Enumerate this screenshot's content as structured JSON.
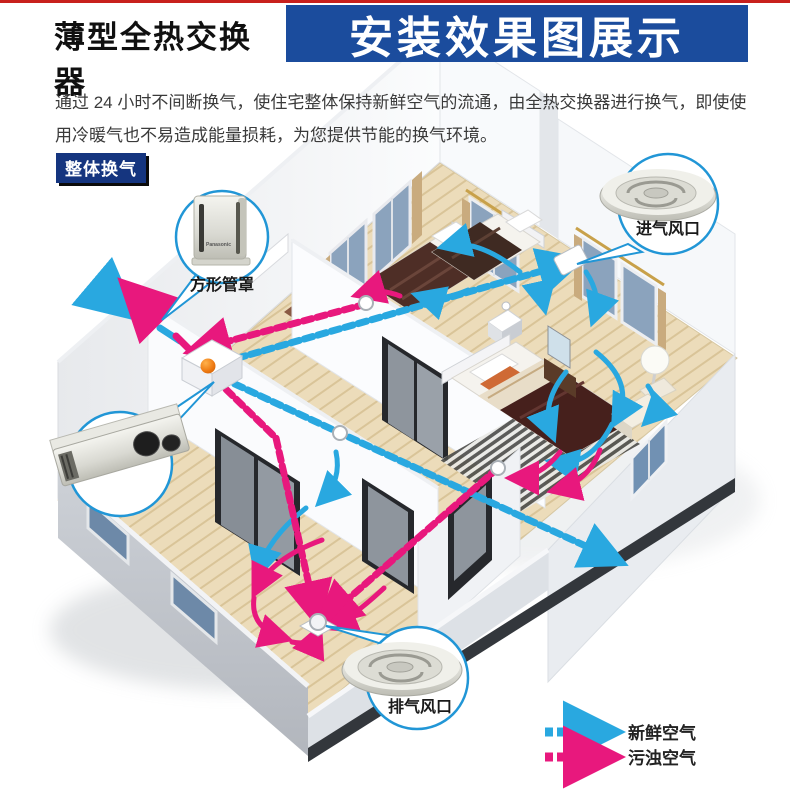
{
  "header": {
    "product_title": "薄型全热交换器",
    "banner_title": "安装效果图展示"
  },
  "intro_text": "通过 24 小时不间断换气，使住宅整体保持新鲜空气的流通，由全热交换器进行换气，即使使用冷暖气也不易造成能量损耗，为您提供节能的换气环境。",
  "section_badge": "整体换气",
  "diagram": {
    "callouts": {
      "square_duct_cover": "方形管罩",
      "intake_vent": "进气风口",
      "exhaust_vent": "排气风口"
    },
    "product_brand": "Panasonic",
    "legend": {
      "fresh_air": "新鲜空气",
      "polluted_air": "污浊空气"
    },
    "colors": {
      "fresh": "#29a8e0",
      "polluted": "#e8187d",
      "banner_blue": "#1b4c9d",
      "badge_navy": "#15357f",
      "top_line_red": "#c8201d"
    }
  }
}
